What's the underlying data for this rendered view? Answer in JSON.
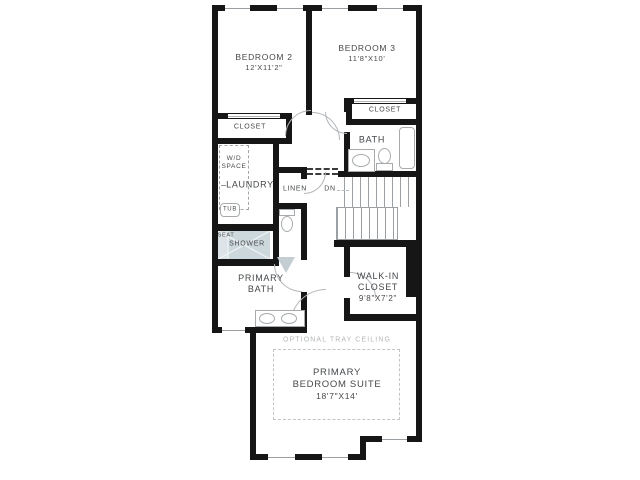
{
  "floor_plan": {
    "rooms": {
      "bedroom2": {
        "name": "BEDROOM 2",
        "dims": "12'X11'2\""
      },
      "bedroom3": {
        "name": "BEDROOM 3",
        "dims": "11'8\"X10'"
      },
      "bedroom2_closet": {
        "name": "CLOSET"
      },
      "bedroom3_closet": {
        "name": "CLOSET"
      },
      "bath": {
        "name": "BATH"
      },
      "laundry": {
        "name": "LAUNDRY"
      },
      "wd_space": {
        "line1": "W/D",
        "line2": "SPACE"
      },
      "laundry_tub": {
        "name": "TUB"
      },
      "shower": {
        "seat": "SEAT",
        "name": "SHOWER"
      },
      "linen": {
        "name": "LINEN"
      },
      "stairs": {
        "down_label": "DN"
      },
      "primary_bath": {
        "line1": "PRIMARY",
        "line2": "BATH"
      },
      "walk_in_closet": {
        "line1": "WALK-IN",
        "line2": "CLOSET",
        "dims": "9'8\"X7'2\""
      },
      "primary_suite": {
        "ceiling_note": "OPTIONAL TRAY CEILING",
        "line1": "PRIMARY",
        "line2": "BEDROOM SUITE",
        "dims": "18'7\"X14'"
      }
    },
    "colors": {
      "wall": "#161616",
      "fixture_outline": "#a7abae",
      "shower_fill": "#ccd8dc",
      "text": "#45484b",
      "muted_text": "#b3b6b8"
    }
  }
}
